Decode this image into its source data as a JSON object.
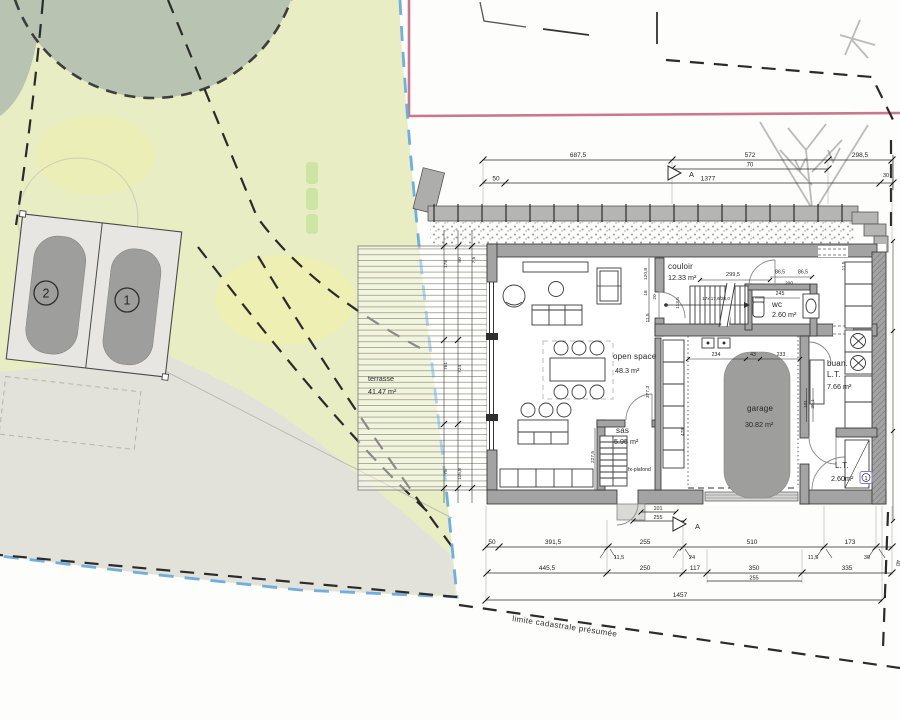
{
  "site": {
    "parking": {
      "stall_1_number": "1",
      "stall_2_number": "2"
    },
    "terrace": {
      "name": "terrasse",
      "area": "41.47 m²"
    },
    "cadastral_boundary_label": "limite cadastrale présumée"
  },
  "floor_plan": {
    "rooms": [
      {
        "id": "open-space",
        "name": "open space",
        "area": "48.3 m²"
      },
      {
        "id": "couloir",
        "name": "couloir",
        "area": "12.33 m²"
      },
      {
        "id": "wc",
        "name": "wc",
        "area": "2.60 m²"
      },
      {
        "id": "sas",
        "name": "sas",
        "area": "5.95 m²",
        "note": "fx-plafond"
      },
      {
        "id": "garage",
        "name": "garage",
        "area": "30.82 m²"
      },
      {
        "id": "buanderie",
        "name": "buan.",
        "name_line2": "L.T.",
        "area": "7.66 m²"
      },
      {
        "id": "lt",
        "name": "L.T.",
        "area": "2.60m²",
        "badge": "1"
      }
    ],
    "stairs_label": "17x 17,6/28,0",
    "section_marker_label": "A"
  },
  "dimensions": {
    "top": [
      {
        "t": "687,5",
        "x": 578,
        "y": 157
      },
      {
        "t": "572",
        "x": 750,
        "y": 157
      },
      {
        "t": "298,5",
        "x": 860,
        "y": 157
      },
      {
        "t": "70",
        "x": 750,
        "y": 166.5,
        "s": 6
      },
      {
        "t": "50",
        "x": 496,
        "y": 180.5
      },
      {
        "t": "1377",
        "x": 708,
        "y": 180.5
      },
      {
        "t": "30",
        "x": 886,
        "y": 177,
        "s": 5.5
      }
    ],
    "bottom": [
      {
        "t": "50",
        "x": 492,
        "y": 544
      },
      {
        "t": "391,5",
        "x": 553,
        "y": 544
      },
      {
        "t": "255",
        "x": 645,
        "y": 544
      },
      {
        "t": "510",
        "x": 752,
        "y": 544
      },
      {
        "t": "173",
        "x": 850,
        "y": 544
      },
      {
        "t": "11,5",
        "x": 619,
        "y": 559,
        "s": 5.6
      },
      {
        "t": "24",
        "x": 692,
        "y": 559,
        "s": 5.6
      },
      {
        "t": "11,5",
        "x": 813,
        "y": 559,
        "s": 5.6
      },
      {
        "t": "30",
        "x": 867,
        "y": 559,
        "s": 5.6
      },
      {
        "t": "40",
        "x": 896,
        "y": 563,
        "s": 5.6,
        "r": 90
      },
      {
        "t": "445,5",
        "x": 547,
        "y": 570
      },
      {
        "t": "250",
        "x": 645,
        "y": 570
      },
      {
        "t": "117",
        "x": 695,
        "y": 570
      },
      {
        "t": "350",
        "x": 754,
        "y": 570
      },
      {
        "t": "335",
        "x": 847,
        "y": 570
      },
      {
        "t": "255",
        "x": 754,
        "y": 579.5,
        "s": 5.6
      },
      {
        "t": "1457",
        "x": 680,
        "y": 597
      }
    ],
    "entry": [
      {
        "t": "101",
        "x": 658,
        "y": 510,
        "s": 5.4
      },
      {
        "t": "255",
        "x": 658,
        "y": 519,
        "s": 5.4
      }
    ],
    "interior": [
      {
        "t": "299,5",
        "x": 733,
        "y": 276,
        "s": 5.6
      },
      {
        "t": "86,5",
        "x": 780,
        "y": 273.5,
        "s": 5.2
      },
      {
        "t": "86,5",
        "x": 803,
        "y": 273.5,
        "s": 5.2
      },
      {
        "t": "200",
        "x": 789,
        "y": 284.5,
        "s": 4.8
      },
      {
        "t": "245",
        "x": 780,
        "y": 295,
        "s": 5.2
      },
      {
        "t": "11,5",
        "x": 845,
        "y": 266,
        "s": 4.8,
        "r": -90
      },
      {
        "t": "234",
        "x": 716,
        "y": 356,
        "s": 5.2
      },
      {
        "t": "43",
        "x": 753,
        "y": 356,
        "s": 5.2
      },
      {
        "t": "233",
        "x": 781,
        "y": 356,
        "s": 5.2
      },
      {
        "t": "120,8",
        "x": 647,
        "y": 274,
        "s": 4.8,
        "r": -90
      },
      {
        "t": "18",
        "x": 647,
        "y": 293,
        "s": 4.8,
        "r": -90
      },
      {
        "t": "20",
        "x": 656,
        "y": 297,
        "s": 4.8,
        "r": -90
      },
      {
        "t": "113,5",
        "x": 679,
        "y": 303,
        "s": 4.8,
        "r": -90
      },
      {
        "t": "11,5",
        "x": 649,
        "y": 318,
        "s": 4.8,
        "r": -90
      },
      {
        "t": "377,3",
        "x": 649,
        "y": 392,
        "s": 4.8,
        "r": -90
      },
      {
        "t": "478",
        "x": 684,
        "y": 432,
        "s": 4.8,
        "r": -90
      },
      {
        "t": "227,5",
        "x": 594,
        "y": 457,
        "s": 4.8,
        "r": -90
      },
      {
        "t": "101",
        "x": 807,
        "y": 404,
        "s": 4.8,
        "r": -90
      },
      {
        "t": "30,1",
        "x": 814,
        "y": 404,
        "s": 4.8,
        "r": -90
      }
    ],
    "terrace": [
      {
        "t": "178",
        "x": 447,
        "y": 264,
        "s": 4.8,
        "r": -90
      },
      {
        "t": "50",
        "x": 461,
        "y": 260,
        "s": 4.8,
        "r": -90
      },
      {
        "t": "7,5",
        "x": 475,
        "y": 260,
        "s": 4.8,
        "r": -90
      },
      {
        "t": "761",
        "x": 447,
        "y": 366,
        "s": 4.8,
        "r": -90
      },
      {
        "t": "724",
        "x": 461,
        "y": 369,
        "s": 4.8,
        "r": -90
      },
      {
        "t": "75",
        "x": 447,
        "y": 472,
        "s": 4.8,
        "r": -90
      },
      {
        "t": "115,8",
        "x": 461,
        "y": 474,
        "s": 4.8,
        "r": -90
      }
    ]
  },
  "colors": {
    "lawn": "#e8edc3",
    "tree": "#b9c3b2",
    "boundary_blue": "#68abdc",
    "boundary_red": "#c0607a",
    "wall_gray": "#a3a3a3",
    "car_gray": "#9e9e9c"
  }
}
